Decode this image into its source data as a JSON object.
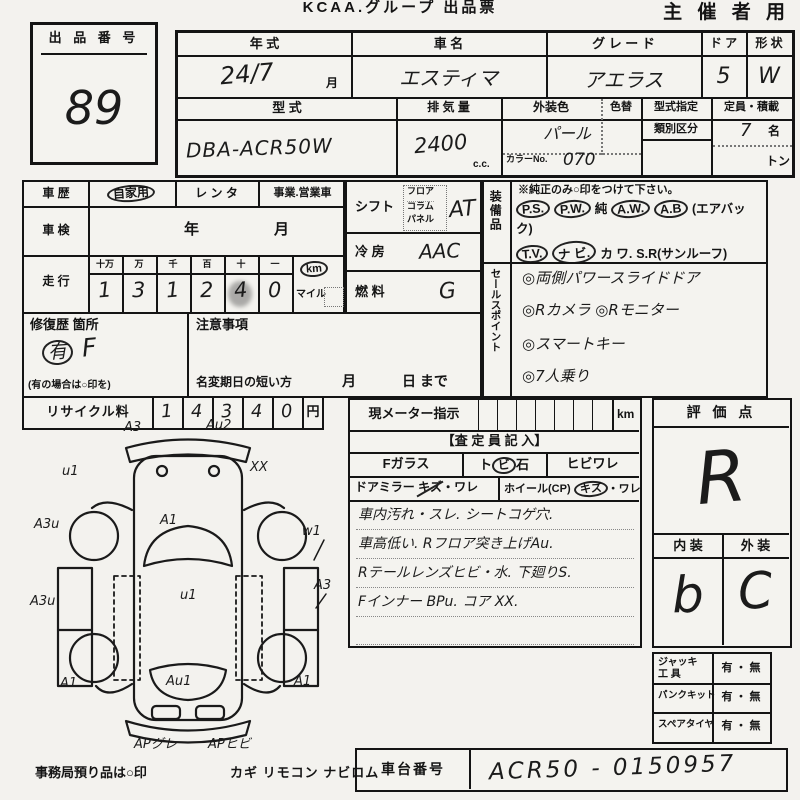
{
  "header": {
    "title": "KCAA.グループ 出品票",
    "corner": "主 催 者 用"
  },
  "lot": {
    "label": "出 品 番 号",
    "number": "89"
  },
  "spec": {
    "h_year": "年  式",
    "h_name": "車    名",
    "h_grade": "グ レ ー ド",
    "h_door": "ド ア",
    "h_shape": "形 状",
    "year": "24/7",
    "year_unit": "月",
    "name": "エスティマ",
    "grade": "アエラス",
    "door": "5",
    "shape": "W",
    "h_model": "型     式",
    "model": "DBA-ACR50W",
    "h_disp": "排 気 量",
    "disp": "2400",
    "disp_unit": "c.c.",
    "h_color": "外装色",
    "color": "パール",
    "h_recolor": "色替",
    "h_colorno": "カラーNo.",
    "color_no": "070",
    "h_typedesig": "型式指定",
    "h_class": "類別区分",
    "h_capacity": "定員・積載",
    "capacity": "7",
    "capacity_unit": "名",
    "load_unit": "トン"
  },
  "history": {
    "label": "車 歴",
    "opt1": "自家用",
    "opt2": "レ ン タ",
    "opt3": "事業.営業車"
  },
  "shaken": {
    "label": "車 検",
    "year_unit": "年",
    "month_unit": "月"
  },
  "mileage": {
    "label": "走 行",
    "u0": "十万",
    "u1": "万",
    "u2": "千",
    "u3": "百",
    "u4": "十",
    "u5": "一",
    "d0": "1",
    "d1": "3",
    "d2": "1",
    "d3": "2",
    "d4": "4",
    "d5": "0",
    "km": "km",
    "mile": "マイル"
  },
  "shift": {
    "label": "シフト",
    "opt0": "フロア",
    "opt1": "コラム",
    "opt2": "パネル",
    "value": "AT"
  },
  "aircon": {
    "label": "冷 房",
    "value": "AAC"
  },
  "fuel": {
    "label": "燃 料",
    "value": "G"
  },
  "equipment": {
    "label": "装備品",
    "note": "※純正のみ○印をつけて下さい。",
    "lines": [
      [
        {
          "t": "P.S.",
          "c": 1
        },
        {
          "t": "P.W.",
          "c": 1
        },
        {
          "t": "純",
          "c": 0
        },
        {
          "t": "A.W.",
          "c": 1
        },
        {
          "t": "A.B",
          "c": 1
        },
        {
          "t": "(エアバック)",
          "c": 0
        }
      ],
      [
        {
          "t": "T.V.",
          "c": 1
        },
        {
          "t": "ナ ビ.",
          "c": 1
        },
        {
          "t": "カ ワ.",
          "c": 0
        },
        {
          "t": "S.R(サンルーフ)",
          "c": 0
        }
      ],
      [
        {
          "t": "ABS",
          "c": 1
        },
        {
          "t": "・ 新車保証書←(注) 後日送りのみ",
          "c": 0
        }
      ]
    ]
  },
  "sales": {
    "label": "セールスポイント",
    "lines": [
      "◎両側パワースライドドア",
      "◎Rカメラ ◎Rモニター",
      "◎スマートキー",
      "◎7人乗り"
    ]
  },
  "repair": {
    "label": "修復歴 箇所",
    "mark": "有",
    "value": "F",
    "note": "(有の場合は○印を)"
  },
  "caution": {
    "label": "注意事項",
    "rename_label": "名変期日の短い方",
    "month": "月",
    "day": "日 まで"
  },
  "recycle": {
    "label": "リサイクル料",
    "d0": "1",
    "d1": "4",
    "d2": "3",
    "d3": "4",
    "d4": "0",
    "unit": "円"
  },
  "meter": {
    "label": "現メーター指示",
    "unit": "km",
    "assessor_header": "【査 定 員 記 入】",
    "fglass": "Fガラス",
    "stone_pre": "ト",
    "stone_circ": "ビ",
    "stone_post": "石",
    "crack": "ヒビワレ",
    "mirror": "ドアミラー",
    "mirror_kizu": "キズ",
    "mirror_ware": "・ワレ",
    "wheel": "ホイール(CP)",
    "wheel_kizu": "キズ",
    "wheel_ware": "・ワレ",
    "notes": [
      "車内汚れ・スレ. シートコゲ穴.",
      "車高低い. Rフロア突き上げAu.",
      "Rテールレンズヒビ・水.  下廻りS.",
      "Fインナー BPu.  コア XX."
    ]
  },
  "score": {
    "label": "評 価 点",
    "value": "R",
    "interior_label": "内 装",
    "exterior_label": "外 装",
    "interior": "b",
    "exterior": "C"
  },
  "tools": {
    "rows": [
      {
        "l1": "ジャッキ",
        "l2": "工  具",
        "value": "有 ・ 無"
      },
      {
        "l1": "パンクキット",
        "l2": "",
        "value": "有 ・ 無"
      },
      {
        "l1": "スペアタイヤ",
        "l2": "",
        "value": "有 ・ 無"
      }
    ]
  },
  "chassis": {
    "label": "車台番号",
    "value": "ACR50 - 0150957"
  },
  "footer": {
    "note": "事務局預り品は○印",
    "items": "カギ  リモコン  ナビロム"
  },
  "diagram": {
    "labels": [
      {
        "t": "A3",
        "x": 96,
        "y": 2
      },
      {
        "t": "Au2",
        "x": 178,
        "y": 0
      },
      {
        "t": "u1",
        "x": 34,
        "y": 46
      },
      {
        "t": "XX",
        "x": 222,
        "y": 42
      },
      {
        "t": "A3u",
        "x": 6,
        "y": 99
      },
      {
        "t": "A1",
        "x": 132,
        "y": 95
      },
      {
        "t": "w1",
        "x": 274,
        "y": 106
      },
      {
        "t": "A3",
        "x": 286,
        "y": 160
      },
      {
        "t": "u1",
        "x": 152,
        "y": 170
      },
      {
        "t": "A3u",
        "x": 2,
        "y": 176
      },
      {
        "t": "A1",
        "x": 32,
        "y": 258
      },
      {
        "t": "Au1",
        "x": 138,
        "y": 256
      },
      {
        "t": "A1",
        "x": 266,
        "y": 256
      },
      {
        "t": "APグレ",
        "x": 106,
        "y": 315
      },
      {
        "t": "APヒビ",
        "x": 180,
        "y": 315
      }
    ]
  }
}
